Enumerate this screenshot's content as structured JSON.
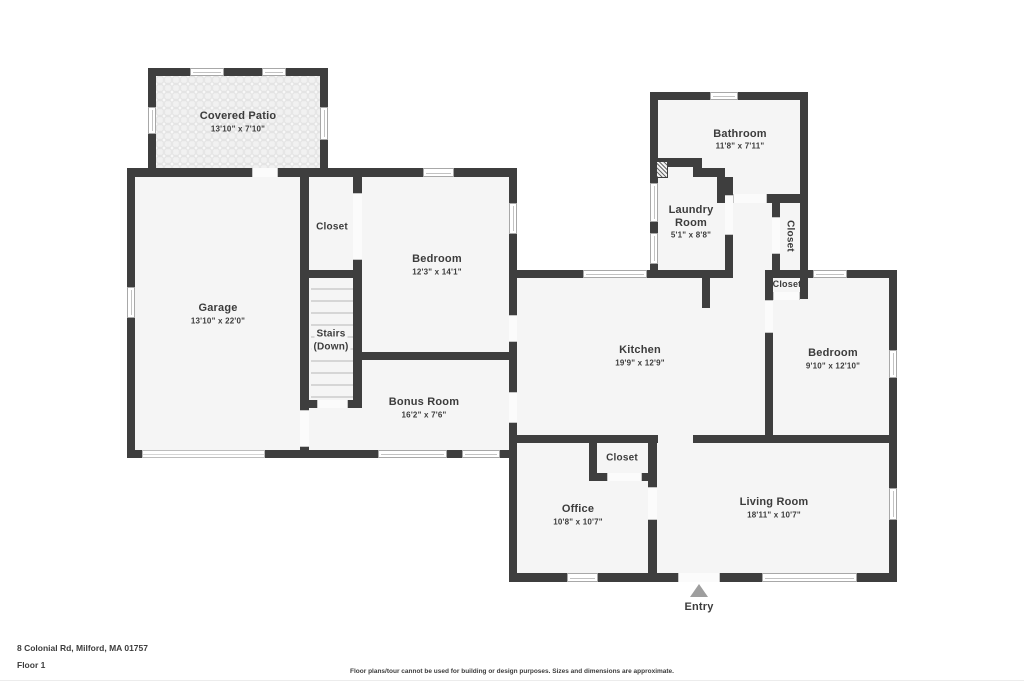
{
  "floorplan": {
    "address": "8 Colonial Rd, Milford, MA 01757",
    "floor": "Floor 1",
    "disclaimer": "Floor plans/tour cannot be used for building or design purposes. Sizes and dimensions are approximate.",
    "entry": "Entry"
  },
  "rooms": {
    "patio": {
      "name": "Covered Patio",
      "dims": "13'10\" x 7'10\""
    },
    "garage": {
      "name": "Garage",
      "dims": "13'10\" x 22'0\""
    },
    "closet_top": {
      "name": "Closet"
    },
    "stairs": {
      "line1": "Stairs",
      "line2": "(Down)"
    },
    "bedroom_top": {
      "name": "Bedroom",
      "dims": "12'3\" x 14'1\""
    },
    "bonus": {
      "name": "Bonus Room",
      "dims": "16'2\" x 7'6\""
    },
    "bathroom": {
      "name": "Bathroom",
      "dims": "11'8\" x 7'11\""
    },
    "laundry": {
      "line1": "Laundry",
      "line2": "Room",
      "dims": "5'1\" x 8'8\""
    },
    "closet_hall": {
      "name": "Closet"
    },
    "closet_bedroom": {
      "name": "Closet"
    },
    "kitchen": {
      "name": "Kitchen",
      "dims": "19'9\" x 12'9\""
    },
    "bedroom_right": {
      "name": "Bedroom",
      "dims": "9'10\" x 12'10\""
    },
    "closet_office": {
      "name": "Closet"
    },
    "office": {
      "name": "Office",
      "dims": "10'8\" x 10'7\""
    },
    "living": {
      "name": "Living Room",
      "dims": "18'11\" x 10'7\""
    }
  },
  "colors": {
    "wall": "#3e3e3e",
    "room_fill": "#f5f5f5",
    "entry_arrow": "#9e9e9e",
    "text": "#3c3c3c"
  }
}
